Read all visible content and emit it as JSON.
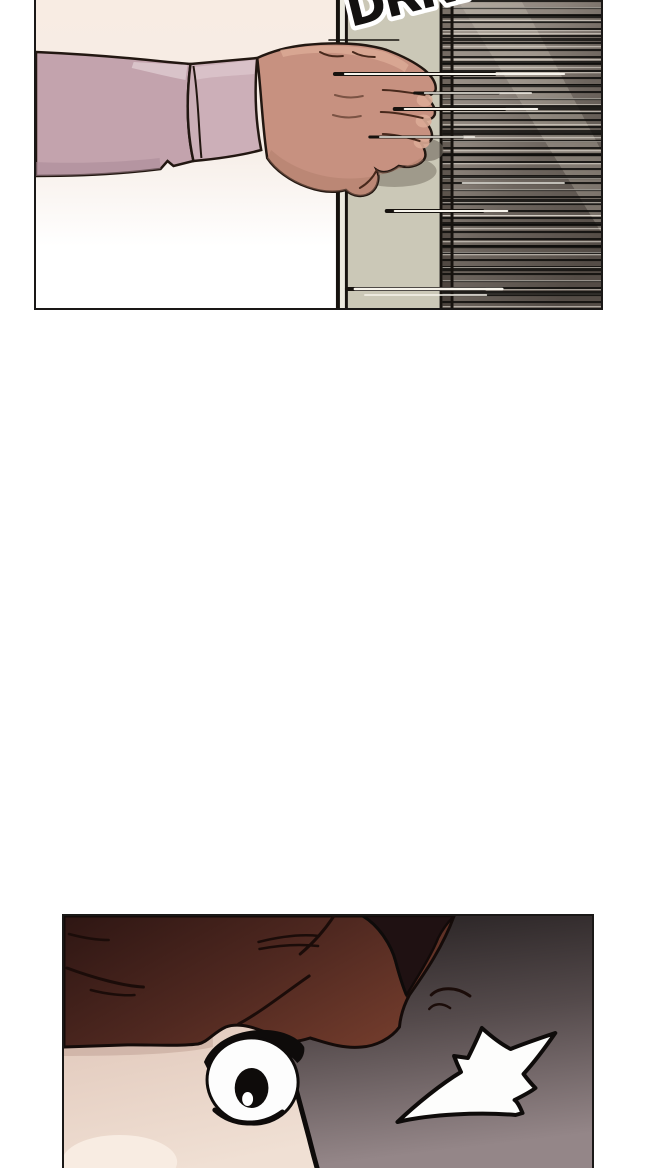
{
  "page": {
    "kind": "webtoon comic strip segment",
    "background": "#ffffff"
  },
  "sfx": {
    "door_rattle": "DRRR"
  },
  "panels": {
    "door": {
      "description": "hand in mauve sleeve grabbing a sliding door edge beside dense motion speed-lines"
    },
    "eye": {
      "description": "close-up of a shocked wide-open eye under dark red-brown hair with an impact flash"
    }
  },
  "colors": {
    "page_bg": "#ffffff",
    "panel_border": "#1a1817",
    "cream": "#f8ece3",
    "cream_mid": "#f5ece5",
    "door_line": "#16120e",
    "door_gap": "#eceadf",
    "door_green": "#cbc8b7",
    "jamb_top": "#7d736a",
    "jamb_bottom": "#49413b",
    "speed_a": "#a59c93",
    "speed_b": "#6e665f",
    "speed_c": "#544c46",
    "stripe_dark": "#0d0c0a",
    "stripe_light": "#e8e2d8",
    "reflection": "#d4ccc0",
    "sfx_fill": "#131110",
    "sfx_stroke": "#ffffff",
    "sleeve": "#c3a3ad",
    "sleeve_hi": "#dcc6cc",
    "sleeve_cuff": "#ccafb8",
    "sleeve_shadow": "#aa8a98",
    "outline": "#221711",
    "hand": "#c79180",
    "hand_hi": "#dcab96",
    "hand_shadow": "#ae7c69",
    "hand_line": "#48291c",
    "door_shadow": "#948e80",
    "door_shadow_dark": "#6f675e",
    "streak_white": "#f7f4ec",
    "bg_top": "#211c1d",
    "bg_mid": "#544a4b",
    "bg_bottom": "#948688",
    "hair_dark": "#2e1613",
    "hair_mid": "#4f2820",
    "hair_red": "#6f3a2b",
    "hair_lobe": "#1f1112",
    "strand": "#1b0c09",
    "ink": "#0e0b0a",
    "eye_white": "#fdfdfd",
    "face_skin": "#e2cabd",
    "face_skin2": "#f0e0d4",
    "face_skin_hi": "#f8ece2",
    "face_shadow": "#c9aca0",
    "flash": "#fdfdfc"
  }
}
